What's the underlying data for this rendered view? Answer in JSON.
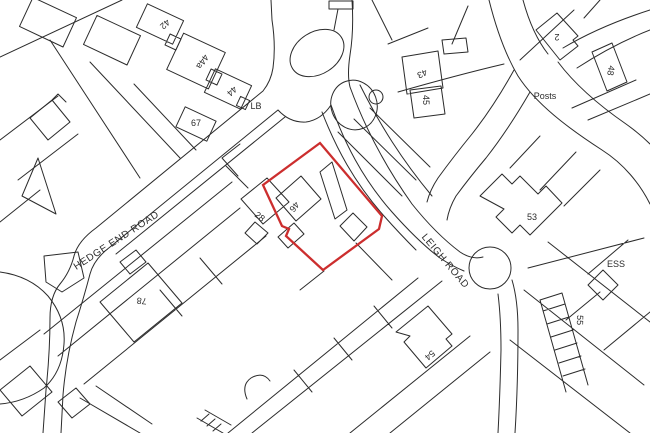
{
  "map": {
    "type": "site-location-plan",
    "background": "#ffffff",
    "line_color": "#2b2b2b",
    "site_boundary_color": "#cc2e2e",
    "labels": {
      "road_1": "HEDGE END ROAD",
      "road_2": "LEIGH ROAD",
      "plot_42": "42",
      "plot_44a": "44a",
      "plot_44": "44",
      "plot_67": "67",
      "lb": "LB",
      "plot_28": "28",
      "plot_46": "46",
      "plot_43": "43",
      "plot_45": "45",
      "plot_2": "2",
      "plot_48": "48",
      "posts": "Posts",
      "plot_53": "53",
      "ess": "ESS",
      "plot_78": "78",
      "plot_55": "55",
      "plot_54": "54"
    }
  }
}
